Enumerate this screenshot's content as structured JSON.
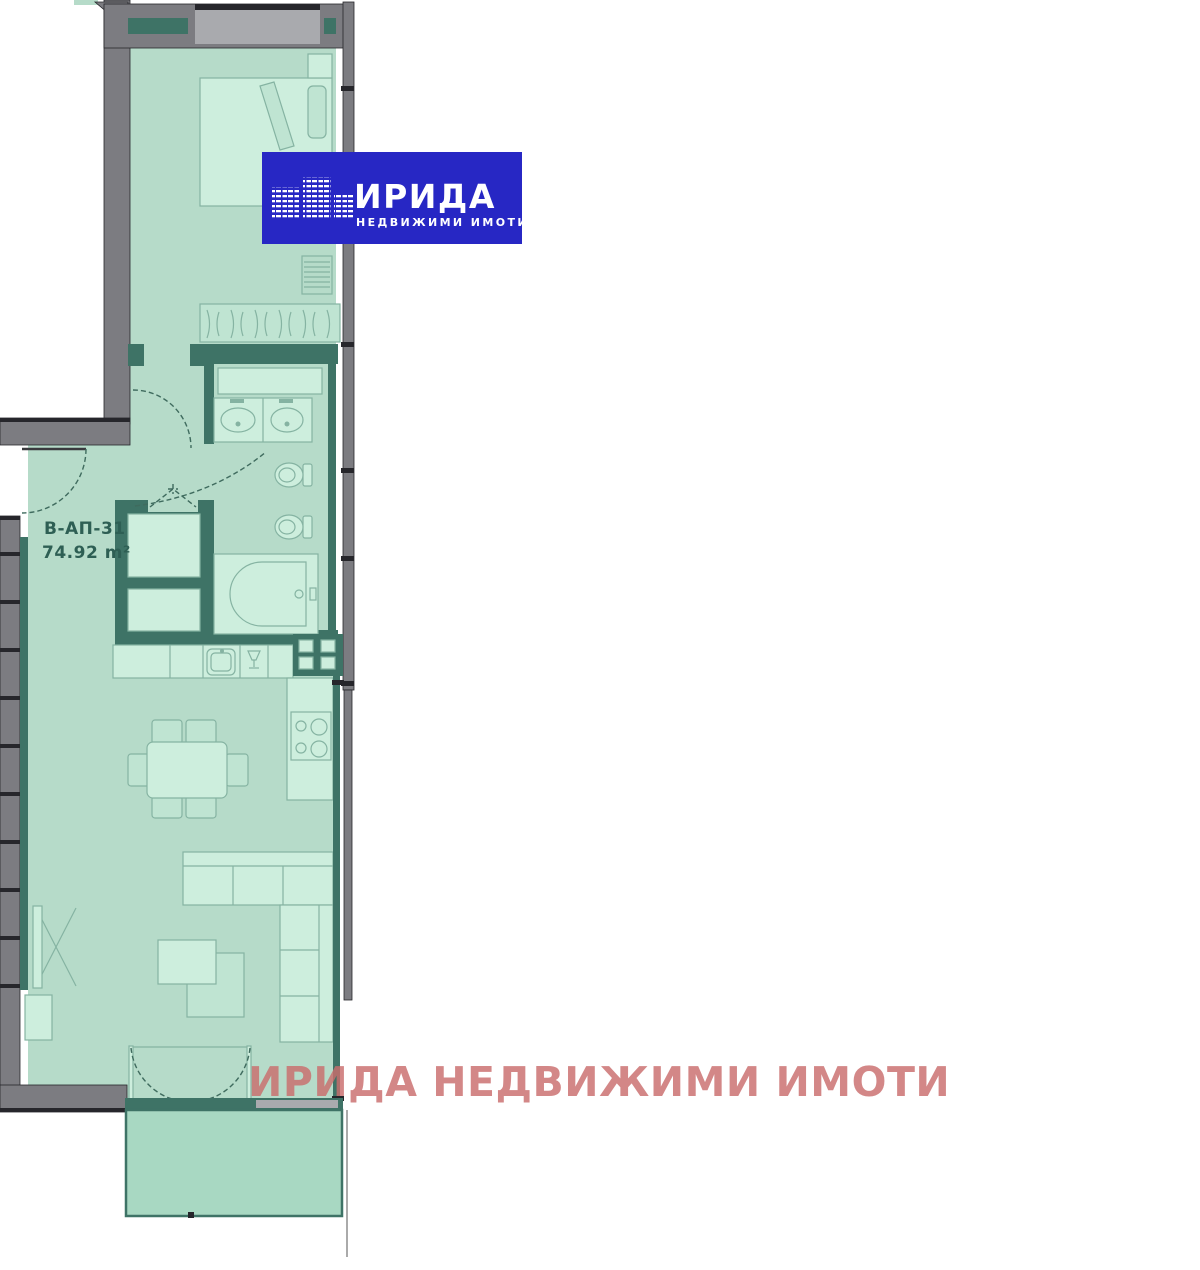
{
  "unit": {
    "label": "В-АП-31",
    "area": "74.92 m²"
  },
  "logo": {
    "title": "ИРИДА",
    "subtitle": "НЕДВИЖИМИ ИМОТИ"
  },
  "watermark": "ИРИДА НЕДВИЖИМИ ИМОТИ",
  "colors": {
    "floor": "#b6dbc9",
    "floor-bright": "#cdeedd",
    "floor-mid": "#bfe4d2",
    "balcony": "#a8d8c2",
    "wall-gray": "#7c7c81",
    "wall-glass": "#a9aaae",
    "wall-dark": "#26262b",
    "partition": "#3e7366",
    "line": "#85b3a2",
    "logo-blue": "#2727c4",
    "watermark": "#c96d6d",
    "label": "#2e5f54"
  }
}
